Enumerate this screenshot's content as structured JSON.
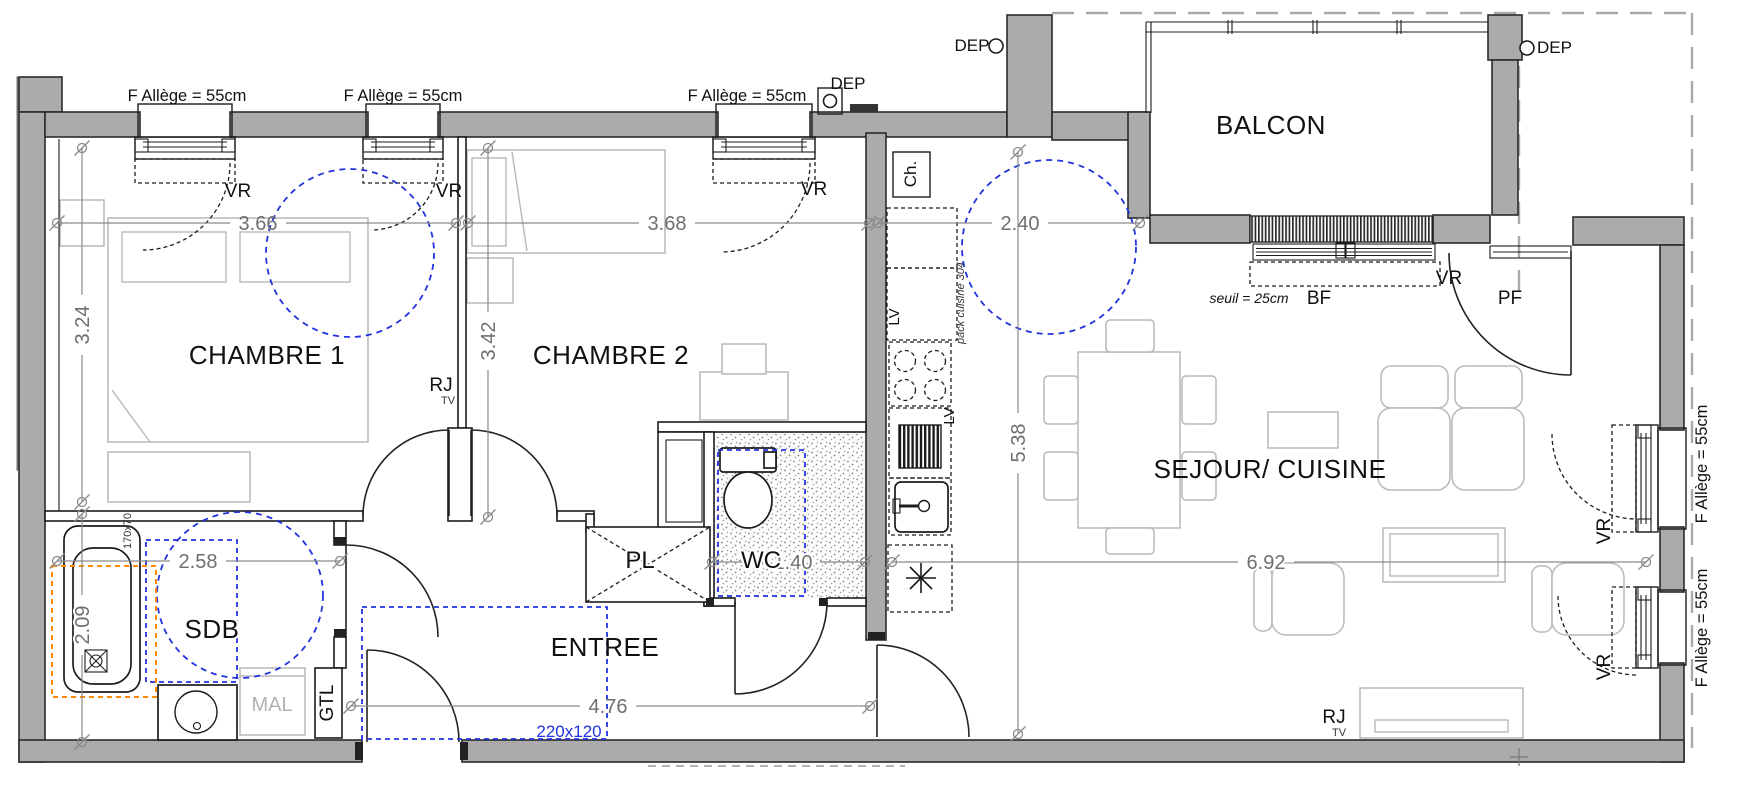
{
  "rooms": {
    "chambre1": "CHAMBRE 1",
    "chambre2": "CHAMBRE 2",
    "sdb": "SDB",
    "entree": "ENTREE",
    "pl": "PL",
    "wc": "WC",
    "sejour": "SEJOUR/ CUISINE",
    "balcon": "BALCON"
  },
  "dims": {
    "ch1_w": "3.66",
    "ch2_w": "3.68",
    "kitchen_w": "2.40",
    "ch1_h": "3.24",
    "ch2_h": "3.42",
    "sejour_h": "5.38",
    "sdb_w": "2.58",
    "sdb_h": "2.09",
    "entree_w": "4.76",
    "sejour_w": "6.92",
    "wc_w": "1.40"
  },
  "notes": {
    "seuil": "seuil = 25cm",
    "door_clearance": "220x120",
    "bathtub_size": "170x70",
    "pack_cuisine": "pack cuisine 304"
  },
  "labels": {
    "allege": "F  Allège = 55cm",
    "vr": "VR",
    "dep": "DEP",
    "bf": "BF",
    "pf": "PF",
    "ch": "Ch.",
    "lv": "LV",
    "mal": "MAL",
    "gtl": "GTL",
    "rj": "RJ",
    "tv": "TV"
  },
  "colors": {
    "wall_gray": "#ababab",
    "clearance_blue": "#2233dd",
    "bathtub_zone_orange": "#ff8a00",
    "dimension_gray": "#8a8a8a"
  }
}
